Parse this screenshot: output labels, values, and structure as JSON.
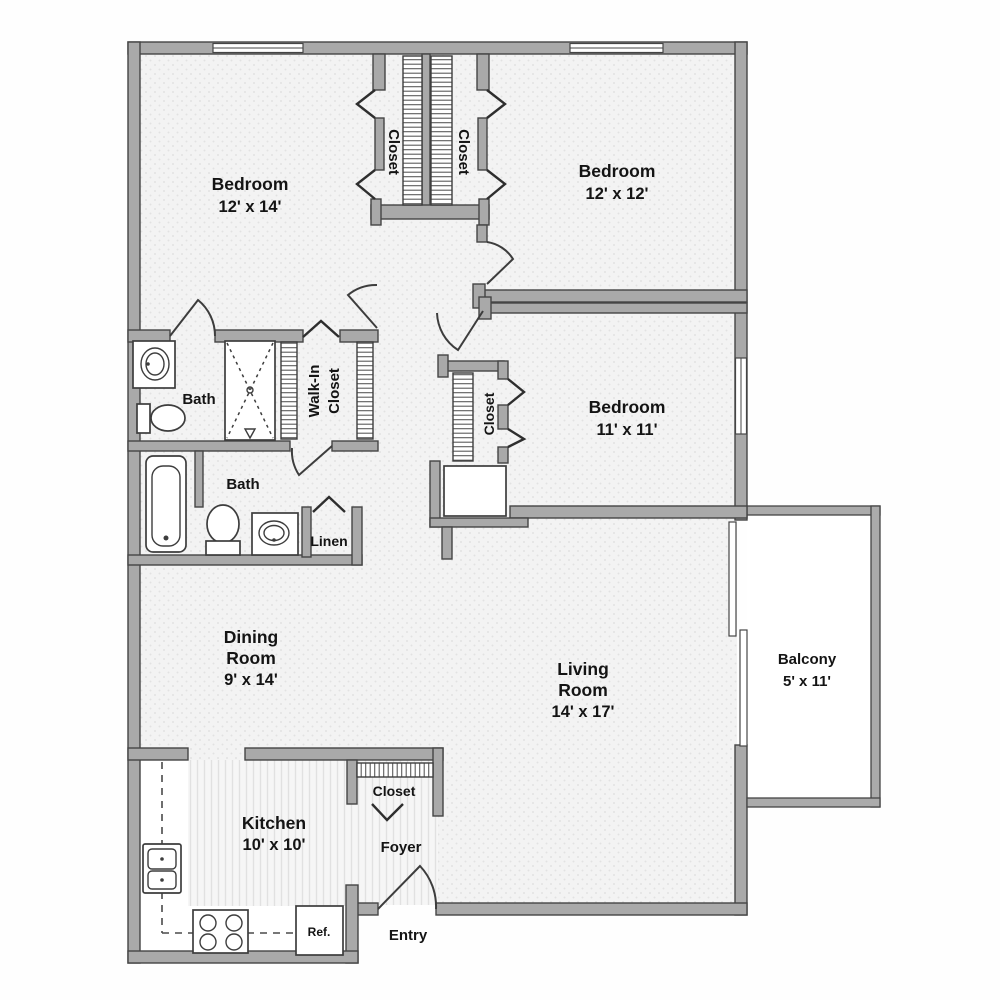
{
  "plan": {
    "bedroom1": {
      "name": "Bedroom",
      "dims": "12' x 14'"
    },
    "bedroom2": {
      "name": "Bedroom",
      "dims": "12' x 12'"
    },
    "bedroom3": {
      "name": "Bedroom",
      "dims": "11' x 11'"
    },
    "bath1": {
      "name": "Bath"
    },
    "bath2": {
      "name": "Bath"
    },
    "walk_in_closet": {
      "line1": "Walk-In",
      "line2": "Closet"
    },
    "closet_left": {
      "name": "Closet"
    },
    "closet_right": {
      "name": "Closet"
    },
    "closet_bedroom3": {
      "name": "Closet"
    },
    "closet_foyer": {
      "name": "Closet"
    },
    "linen": {
      "name": "Linen"
    },
    "dining": {
      "line1": "Dining",
      "line2": "Room",
      "dims": "9' x 14'"
    },
    "living": {
      "line1": "Living",
      "line2": "Room",
      "dims": "14' x 17'"
    },
    "balcony": {
      "name": "Balcony",
      "dims": "5' x 11'"
    },
    "kitchen": {
      "name": "Kitchen",
      "dims": "10' x 10'"
    },
    "foyer": {
      "name": "Foyer"
    },
    "entry": {
      "name": "Entry"
    },
    "refrigerator": {
      "label": "Ref."
    }
  },
  "colors": {
    "wall": "#a9a9a9",
    "wall_outline": "#454545",
    "text": "#141414",
    "floor": "#f3f3f3",
    "floor_dot": "#e2e2e2",
    "background": "#fefefe"
  }
}
